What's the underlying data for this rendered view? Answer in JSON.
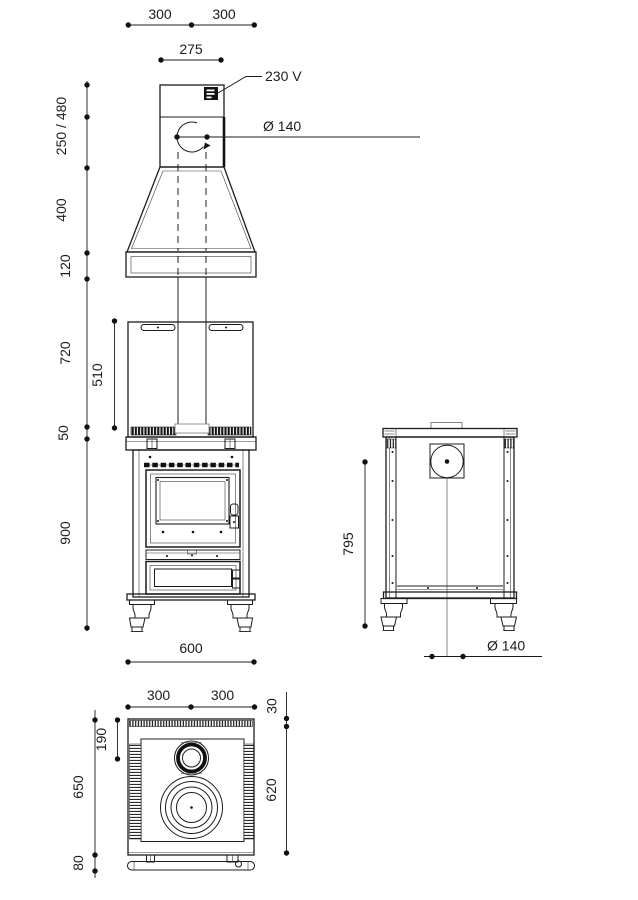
{
  "page": {
    "background": "#ffffff"
  },
  "front_view": {
    "dim_top_left": "300",
    "dim_top_right": "300",
    "dim_connector_width": "275",
    "voltage_label": "230 V",
    "flue_diameter_label": "Ø 140",
    "dim_telescope_height": "250 / 480",
    "dim_hood_height": "400",
    "dim_hood_band_height": "120",
    "dim_back_panel_height": "720",
    "dim_panel_inner_height": "510",
    "dim_top_band_height": "50",
    "dim_body_height": "900",
    "dim_body_width": "600"
  },
  "side_view": {
    "dim_body_height": "795",
    "flue_diameter_label": "Ø 140"
  },
  "top_view": {
    "dim_width_left": "300",
    "dim_width_right": "300",
    "dim_rear_offset": "30",
    "dim_flue_center_offset": "190",
    "dim_depth_total": "650",
    "dim_body_depth": "620",
    "dim_rail_offset": "80"
  }
}
